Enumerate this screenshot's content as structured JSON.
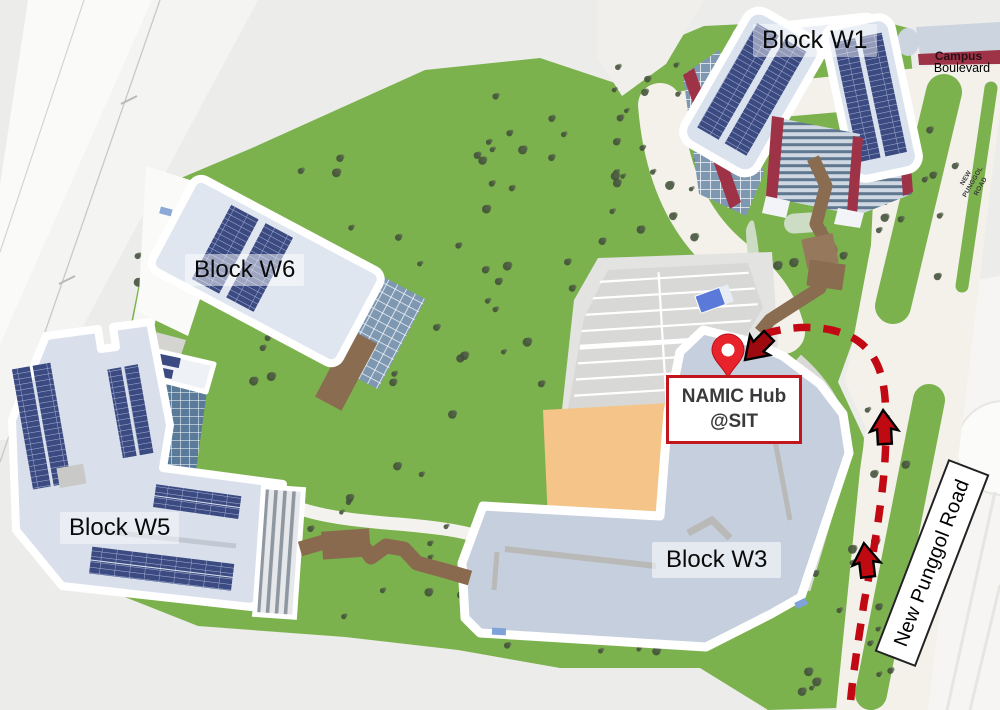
{
  "labels": {
    "block_w1": "Block W1",
    "block_w6": "Block W6",
    "block_w5": "Block W5",
    "block_w3": "Block W3",
    "namic_line1": "NAMIC Hub",
    "namic_line2": "@SIT",
    "new_punggol_road": "New Punggol Road",
    "campus": "Campus",
    "boulevard": "Boulevard",
    "npr_small_1": "NEW",
    "npr_small_2": "PUNGGOL",
    "npr_small_3": "ROAD"
  },
  "colors": {
    "grass": "#7cb24d",
    "road": "#f4f1ea",
    "route_red": "#c10813",
    "pin_red": "#e8232b",
    "callout_border": "#c3161c",
    "building_roof": "#dae2ee",
    "solar_panel": "#3b4a80",
    "boulevard_band": "#9e3347",
    "walkway_brown": "#8a6c51"
  }
}
